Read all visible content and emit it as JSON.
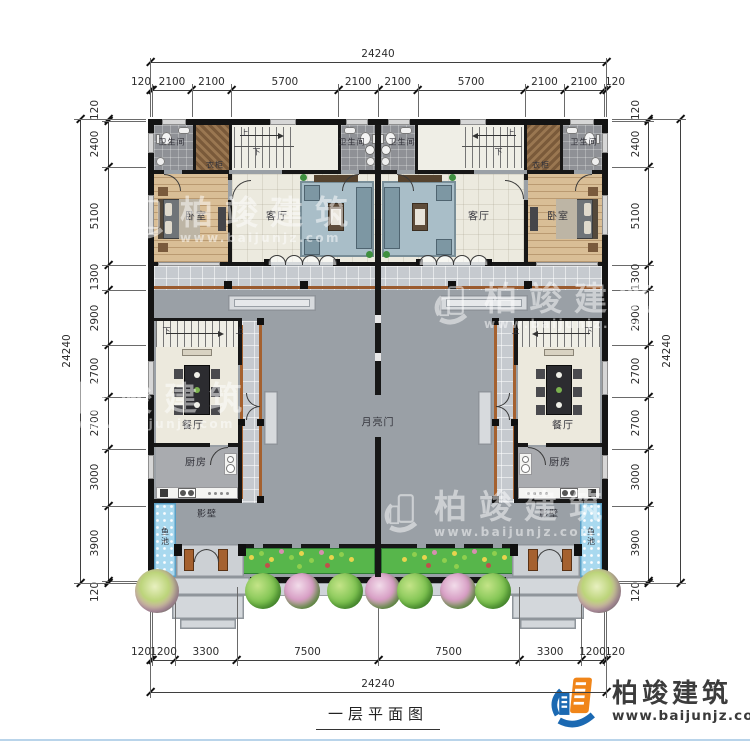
{
  "title": {
    "caption": "一层平面图"
  },
  "brand": {
    "name": "柏竣建筑",
    "url": "www.baijunjz.com",
    "blue": "#1b69b2",
    "orange": "#f08519"
  },
  "watermark": {
    "name": "柏竣建筑",
    "url": "www.baijunjz.com"
  },
  "dimensions": {
    "top": {
      "total": "24240",
      "segments": [
        "120",
        "2100",
        "2100",
        "5700",
        "2100",
        "2100",
        "5700",
        "2100",
        "2100",
        "120"
      ]
    },
    "bottom": {
      "total": "24240",
      "segments": [
        "120",
        "1200",
        "3300",
        "7500",
        "7500",
        "3300",
        "1200",
        "120"
      ]
    },
    "left": {
      "total": "24240",
      "segments": [
        "120",
        "2400",
        "5100",
        "1300",
        "2900",
        "2700",
        "2700",
        "3000",
        "3900",
        "120"
      ]
    },
    "right": {
      "total": "24240",
      "segments": [
        "120",
        "2400",
        "5100",
        "1300",
        "2900",
        "2700",
        "2700",
        "3000",
        "3900",
        "120"
      ]
    }
  },
  "room_labels": [
    {
      "text": "卫生间",
      "x": 172,
      "y": 142,
      "size": 8
    },
    {
      "text": "卫生间",
      "x": 352,
      "y": 142,
      "size": 8
    },
    {
      "text": "卫生间",
      "x": 402,
      "y": 142,
      "size": 8
    },
    {
      "text": "卫生间",
      "x": 584,
      "y": 142,
      "size": 8
    },
    {
      "text": "衣柜",
      "x": 215,
      "y": 165,
      "size": 8
    },
    {
      "text": "衣柜",
      "x": 541,
      "y": 165,
      "size": 8
    },
    {
      "text": "卧室",
      "x": 196,
      "y": 215,
      "size": 10
    },
    {
      "text": "卧室",
      "x": 558,
      "y": 215,
      "size": 10
    },
    {
      "text": "客厅",
      "x": 277,
      "y": 215,
      "size": 10
    },
    {
      "text": "客厅",
      "x": 479,
      "y": 215,
      "size": 10
    },
    {
      "text": "餐厅",
      "x": 193,
      "y": 424,
      "size": 10
    },
    {
      "text": "餐厅",
      "x": 563,
      "y": 424,
      "size": 10
    },
    {
      "text": "厨房",
      "x": 196,
      "y": 461,
      "size": 10
    },
    {
      "text": "厨房",
      "x": 560,
      "y": 461,
      "size": 10
    },
    {
      "text": "月亮门",
      "x": 378,
      "y": 421,
      "size": 10
    },
    {
      "text": "影壁",
      "x": 207,
      "y": 513,
      "size": 9
    },
    {
      "text": "影壁",
      "x": 549,
      "y": 513,
      "size": 9
    },
    {
      "text": "鱼池",
      "x": 165,
      "y": 537,
      "size": 8,
      "vertical": true
    },
    {
      "text": "鱼池",
      "x": 591,
      "y": 537,
      "size": 8,
      "vertical": true
    },
    {
      "text": "上",
      "x": 245,
      "y": 133,
      "size": 8
    },
    {
      "text": "下",
      "x": 257,
      "y": 152,
      "size": 8
    },
    {
      "text": "上",
      "x": 511,
      "y": 133,
      "size": 8
    },
    {
      "text": "下",
      "x": 499,
      "y": 152,
      "size": 8
    },
    {
      "text": "下",
      "x": 167,
      "y": 331,
      "size": 8
    },
    {
      "text": "上",
      "x": 240,
      "y": 331,
      "size": 8
    },
    {
      "text": "下",
      "x": 589,
      "y": 331,
      "size": 8
    },
    {
      "text": "上",
      "x": 516,
      "y": 331,
      "size": 8
    }
  ]
}
